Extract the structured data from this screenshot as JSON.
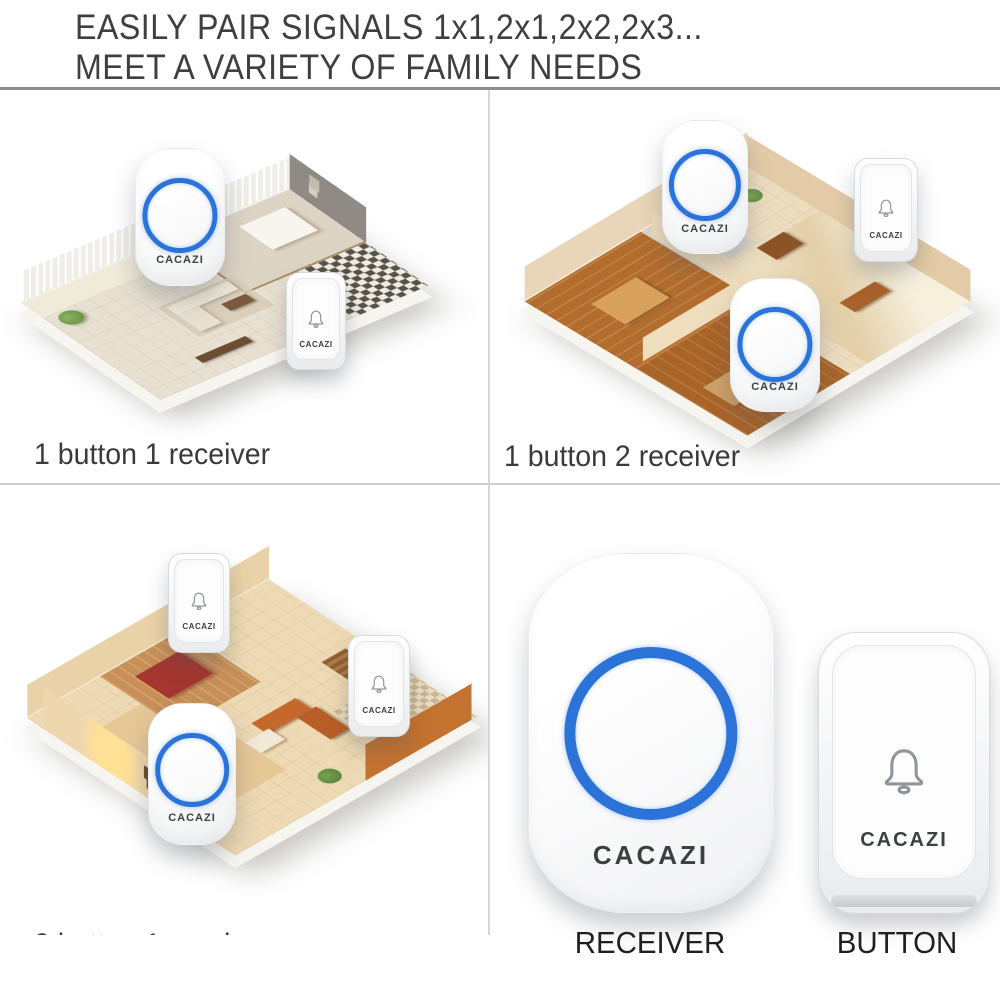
{
  "header": {
    "line1": "EASILY PAIR SIGNALS 1x1,2x1,2x2,2x3...",
    "line2": "MEET A VARIETY OF FAMILY NEEDS"
  },
  "brand": "CACAZI",
  "panels": {
    "top_left": {
      "caption": "1 button 1 receiver",
      "buttons": 1,
      "receivers": 1
    },
    "top_right": {
      "caption": "1 button 2 receiver",
      "buttons": 1,
      "receivers": 2
    },
    "bottom_left": {
      "caption": "2 button 1 receiver",
      "buttons": 2,
      "receivers": 1
    },
    "bottom_right": {
      "receiver_label": "RECEIVER",
      "button_label": "BUTTON"
    }
  },
  "icons": {
    "bell": "bell-outline-icon",
    "ring": "blue-led-ring"
  },
  "colors": {
    "ring_blue": "#2b72d9",
    "header_text": "#3f3f3f",
    "caption_text": "#3a3a3a",
    "label_text": "#1f1f1f",
    "header_rule": "#8e8e8e",
    "divider": "#cfcfcf"
  }
}
